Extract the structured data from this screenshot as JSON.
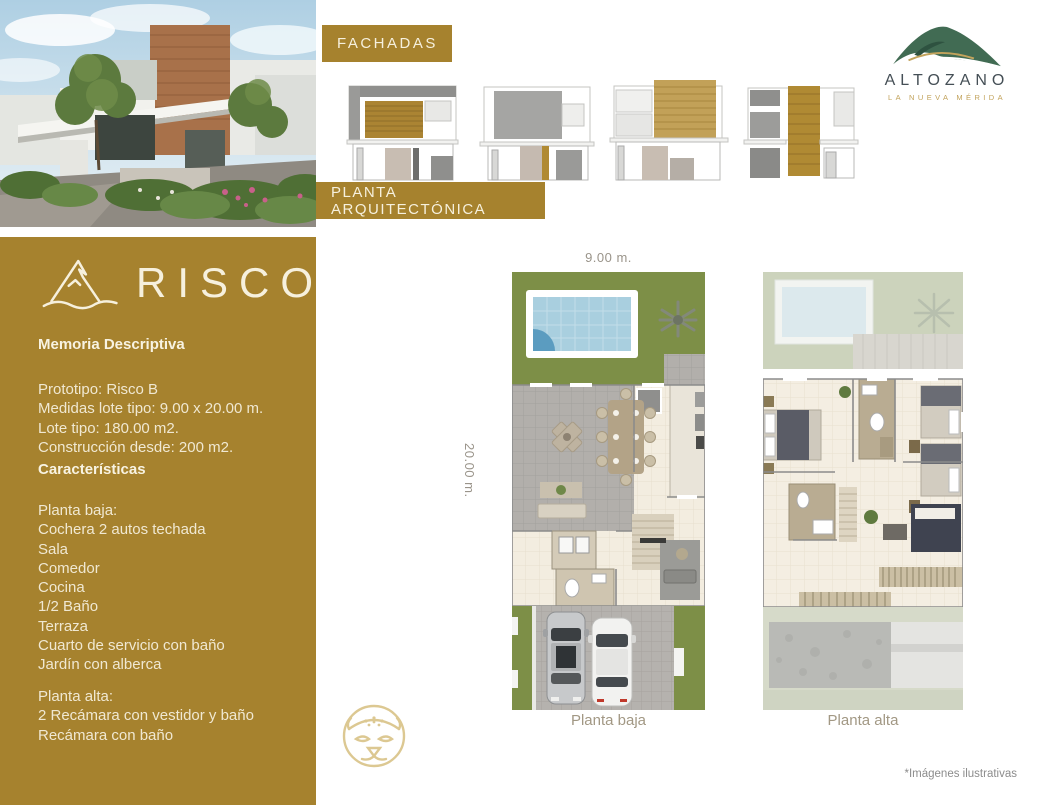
{
  "header": {
    "fachadas_label": "FACHADAS",
    "planta_arquitectonica_label": "PLANTA ARQUITECTÓNICA",
    "developer": {
      "name": "ALTOZANO",
      "tagline": "LA NUEVA MÉRIDA"
    }
  },
  "panel": {
    "project_name": "RISCO",
    "memoria_title": "Memoria Descriptiva",
    "spec_lines": [
      "Prototipo: Risco B",
      "Medidas lote tipo: 9.00 x 20.00 m.",
      "Lote tipo: 180.00 m2.",
      "Construcción desde: 200 m2."
    ],
    "caracteristicas_title": "Características",
    "planta_baja_title": "Planta baja:",
    "planta_baja_items": [
      "Cochera 2 autos techada",
      "Sala",
      "Comedor",
      "Cocina",
      "1/2 Baño",
      "Terraza",
      "Cuarto de servicio con baño",
      "Jardín con alberca"
    ],
    "planta_alta_title": "Planta alta:",
    "planta_alta_items": [
      "2 Recámara con vestidor y baño",
      "Recámara con baño"
    ]
  },
  "plans": {
    "width_dimension": "9.00 m.",
    "depth_dimension": "20.00 m.",
    "planta_baja_caption": "Planta baja",
    "planta_alta_caption": "Planta alta"
  },
  "footnote": "*Imágenes ilustrativas",
  "colors": {
    "gold": "#a6822e",
    "cream": "#f6f0dd",
    "logo_green": "#416b53",
    "logo_gold": "#c2a35c",
    "grass_green": "#7d8f47"
  },
  "icons": {
    "risco_mountain": "mountain-and-wave",
    "altozano_mountain": "green-mountain",
    "jaguar": "jaguar-face-line-art"
  }
}
